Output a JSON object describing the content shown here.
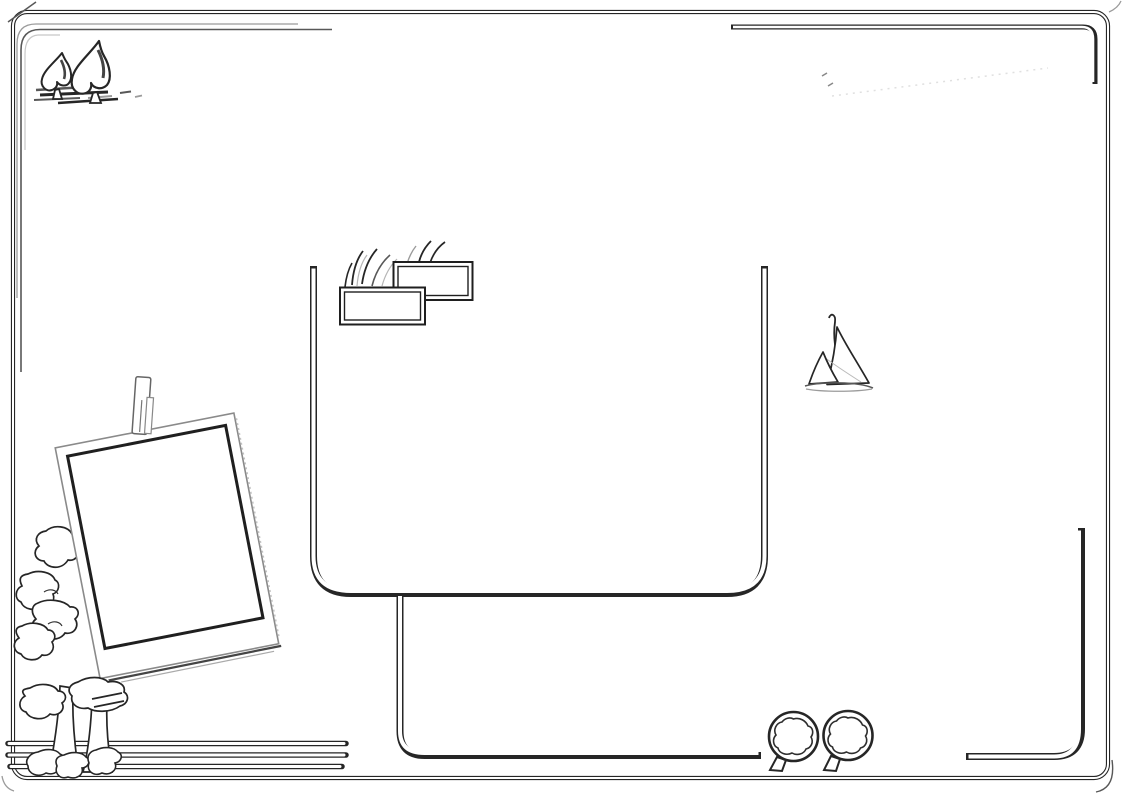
{
  "meta": {
    "description": "Hand-drawn line-art scrapbook sketch page, black ink on white, no text",
    "background": "#ffffff"
  },
  "palette": {
    "ink": "#262626",
    "mid": "#585858",
    "light": "#9b9b9b",
    "faint": "#c8c8c8",
    "shadow": "#444444",
    "white": "#ffffff",
    "bead_fill": "#efefef",
    "bead_stroke": "#555555",
    "bead_solid": "#666666"
  },
  "decor": {
    "stars": {
      "count": 4,
      "items": [
        {
          "x": 866,
          "y": 85,
          "rot": -6
        },
        {
          "x": 922,
          "y": 80,
          "rot": 4
        },
        {
          "x": 978,
          "y": 85,
          "rot": -3
        },
        {
          "x": 1033,
          "y": 84,
          "rot": 7
        }
      ]
    },
    "mini_birds": {
      "count": 14,
      "items": [
        {
          "x": 824,
          "y": 40,
          "s": 0.6
        },
        {
          "x": 842,
          "y": 39,
          "s": 0.66
        },
        {
          "x": 861,
          "y": 39,
          "s": 0.74
        },
        {
          "x": 880,
          "y": 38.5,
          "s": 0.8
        },
        {
          "x": 898,
          "y": 38,
          "s": 0.9
        },
        {
          "x": 916,
          "y": 37.5,
          "s": 1.0
        },
        {
          "x": 934,
          "y": 37,
          "s": 1.1
        },
        {
          "x": 952,
          "y": 36.5,
          "s": 1.2
        },
        {
          "x": 970,
          "y": 36,
          "s": 1.35
        },
        {
          "x": 989,
          "y": 35.5,
          "s": 1.5
        },
        {
          "x": 1008,
          "y": 35,
          "s": 1.7
        },
        {
          "x": 1028,
          "y": 34,
          "s": 1.95
        },
        {
          "x": 1047,
          "y": 36,
          "s": 2.2
        },
        {
          "x": 1058,
          "y": 56,
          "s": 2.6
        }
      ]
    },
    "beads": {
      "column": {
        "x": 1069,
        "y_start": 511,
        "spacing": 9.15,
        "count": 24,
        "radius": 5
      },
      "tail": [
        {
          "x": 1066.5,
          "y": 729.5,
          "r": 5,
          "filled": false
        },
        {
          "x": 1061,
          "y": 737.5,
          "r": 5,
          "filled": false
        },
        {
          "x": 1053,
          "y": 744,
          "r": 5,
          "filled": false
        },
        {
          "x": 1043.5,
          "y": 748,
          "r": 5.2,
          "filled": false
        },
        {
          "x": 1032.5,
          "y": 749.5,
          "r": 4.8,
          "filled": false
        },
        {
          "x": 1021.5,
          "y": 749.5,
          "r": 4.2,
          "filled": false
        },
        {
          "x": 1011,
          "y": 749,
          "r": 3.2,
          "filled": false
        },
        {
          "x": 1000.5,
          "y": 748.5,
          "r": 3,
          "filled": true
        },
        {
          "x": 990.5,
          "y": 748,
          "r": 2.4,
          "filled": true
        },
        {
          "x": 981,
          "y": 747.5,
          "r": 1.8,
          "filled": true
        }
      ]
    },
    "sketch_lines": {
      "items": [
        {
          "x": 17,
          "y1": 320,
          "y2": 468,
          "c": "mid",
          "w": 1.4
        },
        {
          "x": 21,
          "y1": 332,
          "y2": 558,
          "c": "ink",
          "w": 1.6
        },
        {
          "x": 25,
          "y1": 344,
          "y2": 520,
          "c": "mid",
          "w": 1.3
        },
        {
          "x": 30,
          "y1": 354,
          "y2": 552,
          "c": "mid",
          "w": 1.4
        },
        {
          "x": 35,
          "y1": 400,
          "y2": 558,
          "c": "light",
          "w": 1.3
        },
        {
          "x": 40,
          "y1": 414,
          "y2": 552,
          "c": "mid",
          "w": 1.4
        },
        {
          "x": 45,
          "y1": 424,
          "y2": 544,
          "c": "light",
          "w": 1.2
        },
        {
          "x": 50,
          "y1": 432,
          "y2": 470,
          "c": "mid",
          "w": 1.3
        },
        {
          "x": 54,
          "y1": 442,
          "y2": 468,
          "c": "light",
          "w": 1.2
        },
        {
          "x": 58,
          "y1": 446,
          "y2": 462,
          "c": "mid",
          "w": 1.2
        },
        {
          "x": 62,
          "y1": 449,
          "y2": 459,
          "c": "light",
          "w": 1.1
        },
        {
          "x": 66,
          "y1": 444,
          "y2": 456,
          "c": "faint",
          "w": 1.1
        },
        {
          "x": 70,
          "y1": 447,
          "y2": 453,
          "c": "light",
          "w": 1.1
        },
        {
          "x": 38,
          "y1": 470,
          "y2": 560,
          "c": "mid",
          "w": 1.4
        },
        {
          "x": 43,
          "y1": 478,
          "y2": 556,
          "c": "light",
          "w": 1.2
        },
        {
          "x": 48,
          "y1": 486,
          "y2": 550,
          "c": "mid",
          "w": 1.3
        },
        {
          "x": 53,
          "y1": 492,
          "y2": 540,
          "c": "light",
          "w": 1.2
        }
      ]
    }
  }
}
